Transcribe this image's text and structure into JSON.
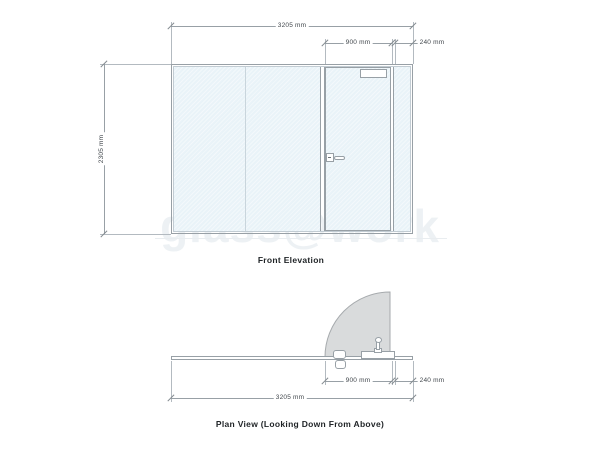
{
  "watermark_text": "glass@work",
  "front_elevation": {
    "title": "Front Elevation",
    "dim_overall_width": "3205 mm",
    "dim_door_width": "900 mm",
    "dim_side_panel_width": "240 mm",
    "dim_height": "2305 mm"
  },
  "plan_view": {
    "title": "Plan View (Looking Down From Above)",
    "dim_door_width": "900 mm",
    "dim_side_panel_width": "240 mm",
    "dim_overall_width": "3205 mm"
  },
  "colors": {
    "glass": "#e9f3f8",
    "line": "#98a0a6",
    "ext_line": "#b3bac0",
    "dim_text": "#41474c",
    "title_text": "#1f2326",
    "swing_fill": "#d9dbdc",
    "swing_stroke": "#a6aaad",
    "watermark": "#e2e9ee"
  }
}
